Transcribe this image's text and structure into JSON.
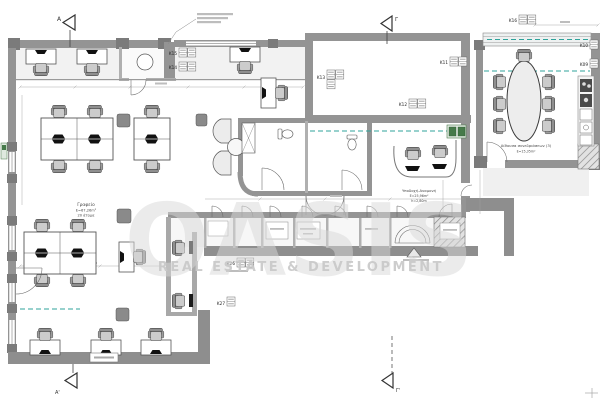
{
  "watermark": {
    "brand": "OASIS",
    "tagline": "REAL ESTATE & DEVELOPMENT"
  },
  "section_markers": {
    "a_top": "Α",
    "gamma_top": "Γ",
    "a_bottom": "Α'",
    "gamma_bottom": "Γ'"
  },
  "rooms": {
    "office": {
      "name": "Γραφείο",
      "area": "E=67,26m²",
      "capacity": "20 άτομα"
    },
    "reception": {
      "name": "Υποδοχή-Αναμονή",
      "area": "E=25,96m²",
      "height": "h=2,80m"
    },
    "meeting_room": {
      "name": "Αίθουσα συνεδριάσεων (3)",
      "area": "E=15,35m²"
    }
  },
  "furniture_tags": {
    "k09": "K09",
    "k10": "K10",
    "k11": "K11",
    "k12": "K12",
    "k13": "K13",
    "k14": "K14",
    "k15": "K15",
    "k16": "K16",
    "k26": "K26",
    "k27": "K27"
  },
  "colors": {
    "wall": "#949494",
    "wall_dark": "#7b7b7b",
    "teal_dashed": "#2fa39b",
    "plant_green": "#467a4a",
    "watermark": "#d9d9d9"
  }
}
